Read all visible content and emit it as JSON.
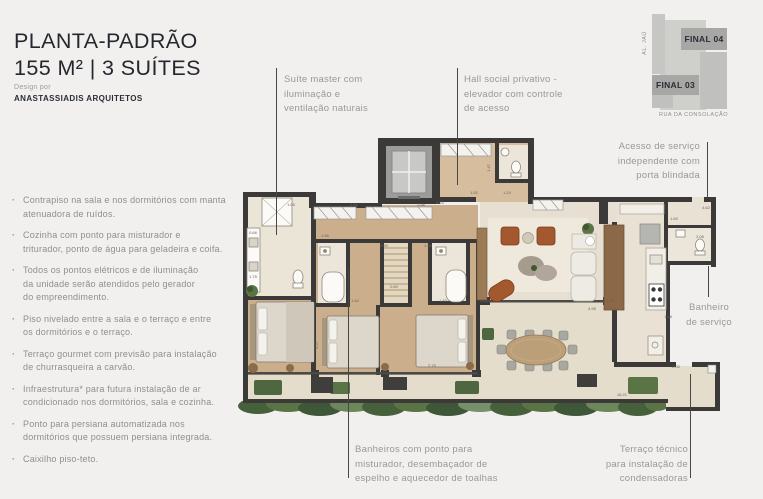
{
  "header": {
    "title_line1": "PLANTA-PADRÃO",
    "title_line2": "155 M² | 3 SUÍTES",
    "design_label": "Design por",
    "design_name": "ANASTASSIADIS ARQUITETOS"
  },
  "features": [
    "Contrapiso na sala e nos dormitórios com manta\natenuadora de ruídos.",
    "Cozinha com ponto para misturador e\ntriturador, ponto de água para geladeira e coifa.",
    "Todos os pontos elétricos e de iluminação\nda unidade serão atendidos pelo gerador\ndo empreendimento.",
    "Piso nivelado entre a sala e o terraço e entre\nos dormitórios e o terraço.",
    "Terraço gourmet com previsão para instalação\nde churrasqueira a carvão.",
    "Infraestrutura* para futura instalação de ar\ncondicionado nos dormitórios, sala e cozinha.",
    "Ponto para persiana automatizada nos\ndormitórios que possuem persiana integrada.",
    "Caixilho piso-teto."
  ],
  "callouts": {
    "suite_master": "Suíte master com\niluminação e\nventilação naturais",
    "hall_social": "Hall social privativo -\nelevador com controle\nde acesso",
    "acesso_servico": "Acesso de serviço\nindependente com\nporta blindada",
    "banheiro_servico": "Banheiro\nde serviço",
    "banheiros": "Banheiros com ponto para\nmisturador, desembaçador de\nespelho e aquecedor de toalhas",
    "terraco_tecnico": "Terraço técnico\npara instalação de\ncondensadoras"
  },
  "minimap": {
    "final_04": "FINAL 04",
    "final_03": "FINAL 03",
    "street_left": "AL. JAÚ",
    "street_bottom": "RUA DA CONSOLAÇÃO"
  },
  "plan": {
    "dimensions": [
      {
        "t": "1.05",
        "x": 291,
        "y": 206
      },
      {
        "t": "2.56",
        "x": 354,
        "y": 206
      },
      {
        "t": "2.56",
        "x": 421,
        "y": 206
      },
      {
        "t": "6.53",
        "x": 440,
        "y": 204
      },
      {
        "t": "1.52",
        "x": 474,
        "y": 194
      },
      {
        "t": "1.24",
        "x": 507,
        "y": 194
      },
      {
        "t": "1.47",
        "x": 490,
        "y": 168,
        "r": -90
      },
      {
        "t": "0.66",
        "x": 253,
        "y": 234
      },
      {
        "t": "1.75",
        "x": 253,
        "y": 278
      },
      {
        "t": "1.56",
        "x": 325,
        "y": 237
      },
      {
        "t": "0.90",
        "x": 384,
        "y": 247
      },
      {
        "t": "1.50",
        "x": 428,
        "y": 247
      },
      {
        "t": "1.40",
        "x": 355,
        "y": 302
      },
      {
        "t": "1.40",
        "x": 443,
        "y": 302
      },
      {
        "t": "0.80",
        "x": 394,
        "y": 288
      },
      {
        "t": "5.27",
        "x": 318,
        "y": 345,
        "r": -90
      },
      {
        "t": "2.75",
        "x": 432,
        "y": 367
      },
      {
        "t": "4.95",
        "x": 592,
        "y": 310
      },
      {
        "t": "2.36",
        "x": 610,
        "y": 302
      },
      {
        "t": "1.60",
        "x": 674,
        "y": 220
      },
      {
        "t": "1.68",
        "x": 668,
        "y": 318
      },
      {
        "t": "4.62",
        "x": 706,
        "y": 209
      },
      {
        "t": "2.06",
        "x": 700,
        "y": 238
      },
      {
        "t": "2.00",
        "x": 676,
        "y": 368
      },
      {
        "t": "16.21",
        "x": 622,
        "y": 396
      }
    ]
  },
  "colors": {
    "wall": "#3b3a38",
    "wood_floor": "#cbae8c",
    "stone_floor": "#e7e0d2",
    "terrace_floor": "#e5ddcb",
    "greenery": "#5b7446",
    "leather": "#a3582e",
    "text_gray": "#96989b",
    "title": "#24272e"
  }
}
